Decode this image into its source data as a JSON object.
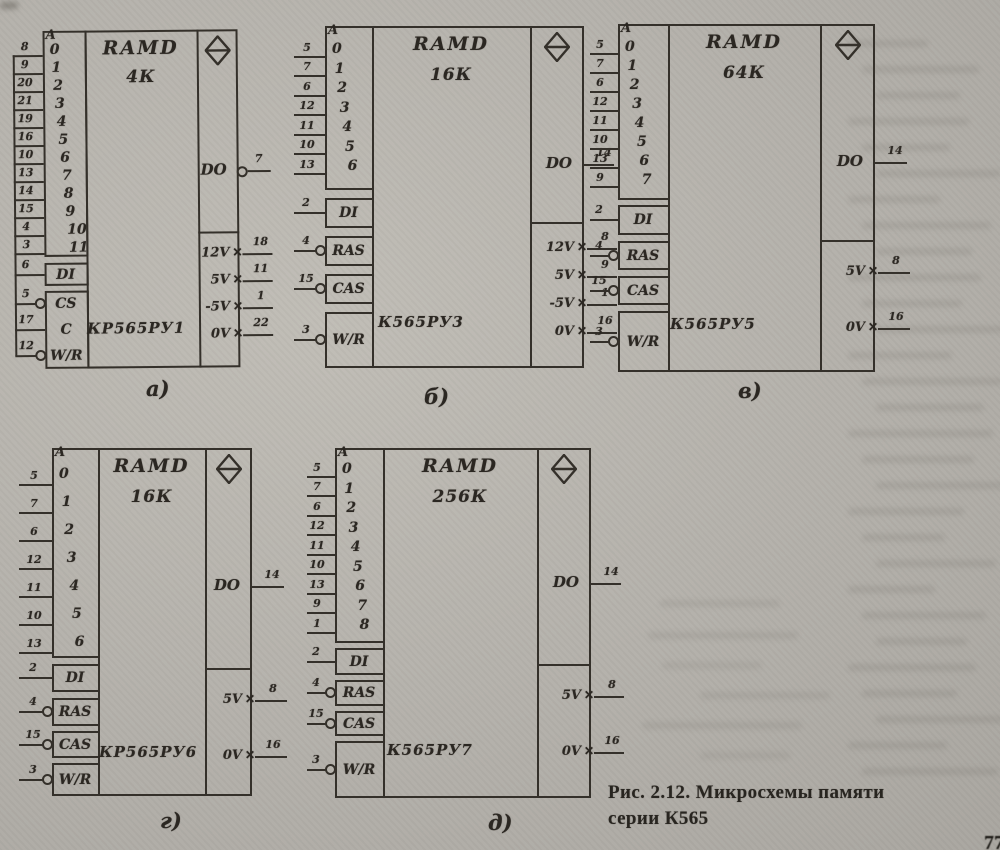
{
  "figure": {
    "caption_line1": "Рис. 2.12. Микросхемы памяти",
    "caption_line2": "серии К565",
    "page_corner_mark": "77"
  },
  "marks": {
    "power_input_mark": "✕"
  },
  "chips": [
    {
      "sublabel": "а)",
      "type_label": "RAMD",
      "capacity": "4К",
      "part_number": "КР565РУ1",
      "address_port": {
        "header": "A",
        "bits": [
          "0",
          "1",
          "2",
          "3",
          "4",
          "5",
          "6",
          "7",
          "8",
          "9",
          "10",
          "11"
        ],
        "pins": [
          "8",
          "9",
          "20",
          "21",
          "19",
          "16",
          "10",
          "13",
          "14",
          "15",
          "4",
          "3"
        ]
      },
      "controls": [
        {
          "label": "DI",
          "pin": "6",
          "inverted": false
        },
        {
          "label": "CS",
          "pin": "5",
          "inverted": true
        },
        {
          "label": "C",
          "pin": "17",
          "inverted": false
        },
        {
          "label": "W/R",
          "pin": "12",
          "inverted": true
        }
      ],
      "output": {
        "label": "DO",
        "pin": "7",
        "inverted": true
      },
      "power": [
        {
          "label": "12V",
          "pin": "18"
        },
        {
          "label": "5V",
          "pin": "11"
        },
        {
          "label": "-5V",
          "pin": "1"
        },
        {
          "label": "0V",
          "pin": "22"
        }
      ]
    },
    {
      "sublabel": "б)",
      "type_label": "RAMD",
      "capacity": "16К",
      "part_number": "К565РУ3",
      "address_port": {
        "header": "A",
        "bits": [
          "0",
          "1",
          "2",
          "3",
          "4",
          "5",
          "6"
        ],
        "pins": [
          "5",
          "7",
          "6",
          "12",
          "11",
          "10",
          "13"
        ]
      },
      "controls": [
        {
          "label": "DI",
          "pin": "2",
          "inverted": false
        },
        {
          "label": "RAS",
          "pin": "4",
          "inverted": true
        },
        {
          "label": "CAS",
          "pin": "15",
          "inverted": true
        },
        {
          "label": "W/R",
          "pin": "3",
          "inverted": true
        }
      ],
      "output": {
        "label": "DO",
        "pin": "14",
        "inverted": false
      },
      "power": [
        {
          "label": "12V",
          "pin": "8"
        },
        {
          "label": "5V",
          "pin": "9"
        },
        {
          "label": "-5V",
          "pin": "1"
        },
        {
          "label": "0V",
          "pin": "16"
        }
      ]
    },
    {
      "sublabel": "в)",
      "type_label": "RAMD",
      "capacity": "64К",
      "part_number": "К565РУ5",
      "address_port": {
        "header": "A",
        "bits": [
          "0",
          "1",
          "2",
          "3",
          "4",
          "5",
          "6",
          "7"
        ],
        "pins": [
          "5",
          "7",
          "6",
          "12",
          "11",
          "10",
          "13",
          "9"
        ]
      },
      "controls": [
        {
          "label": "DI",
          "pin": "2",
          "inverted": false
        },
        {
          "label": "RAS",
          "pin": "4",
          "inverted": true
        },
        {
          "label": "CAS",
          "pin": "15",
          "inverted": true
        },
        {
          "label": "W/R",
          "pin": "3",
          "inverted": true
        }
      ],
      "output": {
        "label": "DO",
        "pin": "14",
        "inverted": false
      },
      "power": [
        {
          "label": "5V",
          "pin": "8"
        },
        {
          "label": "0V",
          "pin": "16"
        }
      ]
    },
    {
      "sublabel": "г)",
      "type_label": "RAMD",
      "capacity": "16К",
      "part_number": "КР565РУ6",
      "address_port": {
        "header": "A",
        "bits": [
          "0",
          "1",
          "2",
          "3",
          "4",
          "5",
          "6"
        ],
        "pins": [
          "5",
          "7",
          "6",
          "12",
          "11",
          "10",
          "13"
        ]
      },
      "controls": [
        {
          "label": "DI",
          "pin": "2",
          "inverted": false
        },
        {
          "label": "RAS",
          "pin": "4",
          "inverted": true
        },
        {
          "label": "CAS",
          "pin": "15",
          "inverted": true
        },
        {
          "label": "W/R",
          "pin": "3",
          "inverted": true
        }
      ],
      "output": {
        "label": "DO",
        "pin": "14",
        "inverted": false
      },
      "power": [
        {
          "label": "5V",
          "pin": "8"
        },
        {
          "label": "0V",
          "pin": "16"
        }
      ]
    },
    {
      "sublabel": "д)",
      "type_label": "RAMD",
      "capacity": "256К",
      "part_number": "К565РУ7",
      "address_port": {
        "header": "A",
        "bits": [
          "0",
          "1",
          "2",
          "3",
          "4",
          "5",
          "6",
          "7",
          "8"
        ],
        "pins": [
          "5",
          "7",
          "6",
          "12",
          "11",
          "10",
          "13",
          "9",
          "1"
        ]
      },
      "controls": [
        {
          "label": "DI",
          "pin": "2",
          "inverted": false
        },
        {
          "label": "RAS",
          "pin": "4",
          "inverted": true
        },
        {
          "label": "CAS",
          "pin": "15",
          "inverted": true
        },
        {
          "label": "W/R",
          "pin": "3",
          "inverted": true
        }
      ],
      "output": {
        "label": "DO",
        "pin": "14",
        "inverted": false
      },
      "power": [
        {
          "label": "5V",
          "pin": "8"
        },
        {
          "label": "0V",
          "pin": "16"
        }
      ]
    }
  ]
}
